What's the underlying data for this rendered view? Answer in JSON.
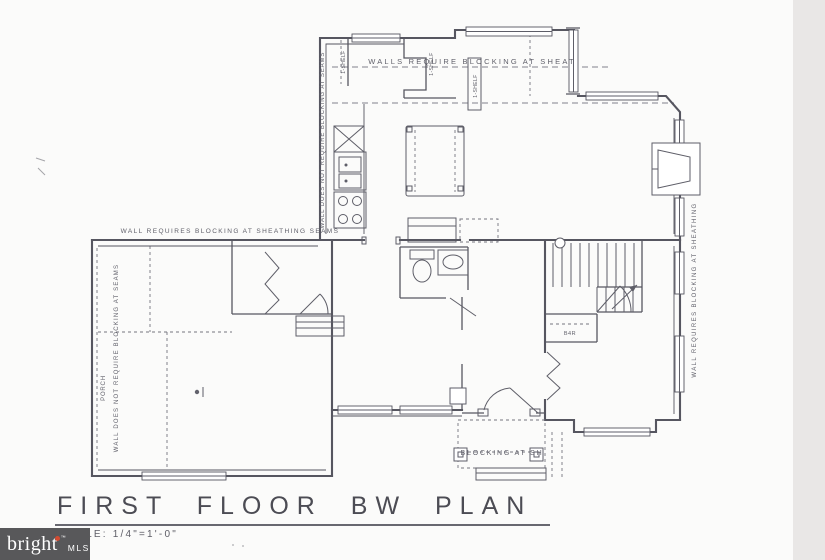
{
  "colors": {
    "paper": "#fbfbfa",
    "ink": "#565660",
    "label": "#60606a",
    "dash": "#82828c",
    "edge_band": "#e9e7e6",
    "logo_bg": "#58585a",
    "logo_text": "#ffffff",
    "logo_accent": "#d14b32",
    "title_ink": "#4c4c54"
  },
  "title_block": {
    "title": "FIRST FLOOR BW PLAN",
    "scale": "SCALE: 1/4\"=1'-0\""
  },
  "logo": {
    "brand": "bright",
    "tm": "™",
    "suffix": "MLS"
  },
  "plan_labels": {
    "top_note": "WALLS REQUIRE BLOCKING AT SHEAT",
    "mid_note": "WALL REQUIRES BLOCKING AT SHEATHING SEAMS",
    "kitchen_wall_note": "WALL DOES NOT REQUIRE BLOCKING AT SEAMS",
    "left_wall_note": "WALL DOES NOT REQUIRE BLOCKING AT SEAMS",
    "right_wall_note": "WALL REQUIRES BLOCKING AT SHEATHING",
    "porch_label": "PORCH",
    "blocking_note": "BLOCKING AT SH",
    "shelf_a": "1-SHELF",
    "shelf_b": "1-SHELF",
    "shelf_c": "1-SHELF",
    "closet_label": "B4R"
  }
}
